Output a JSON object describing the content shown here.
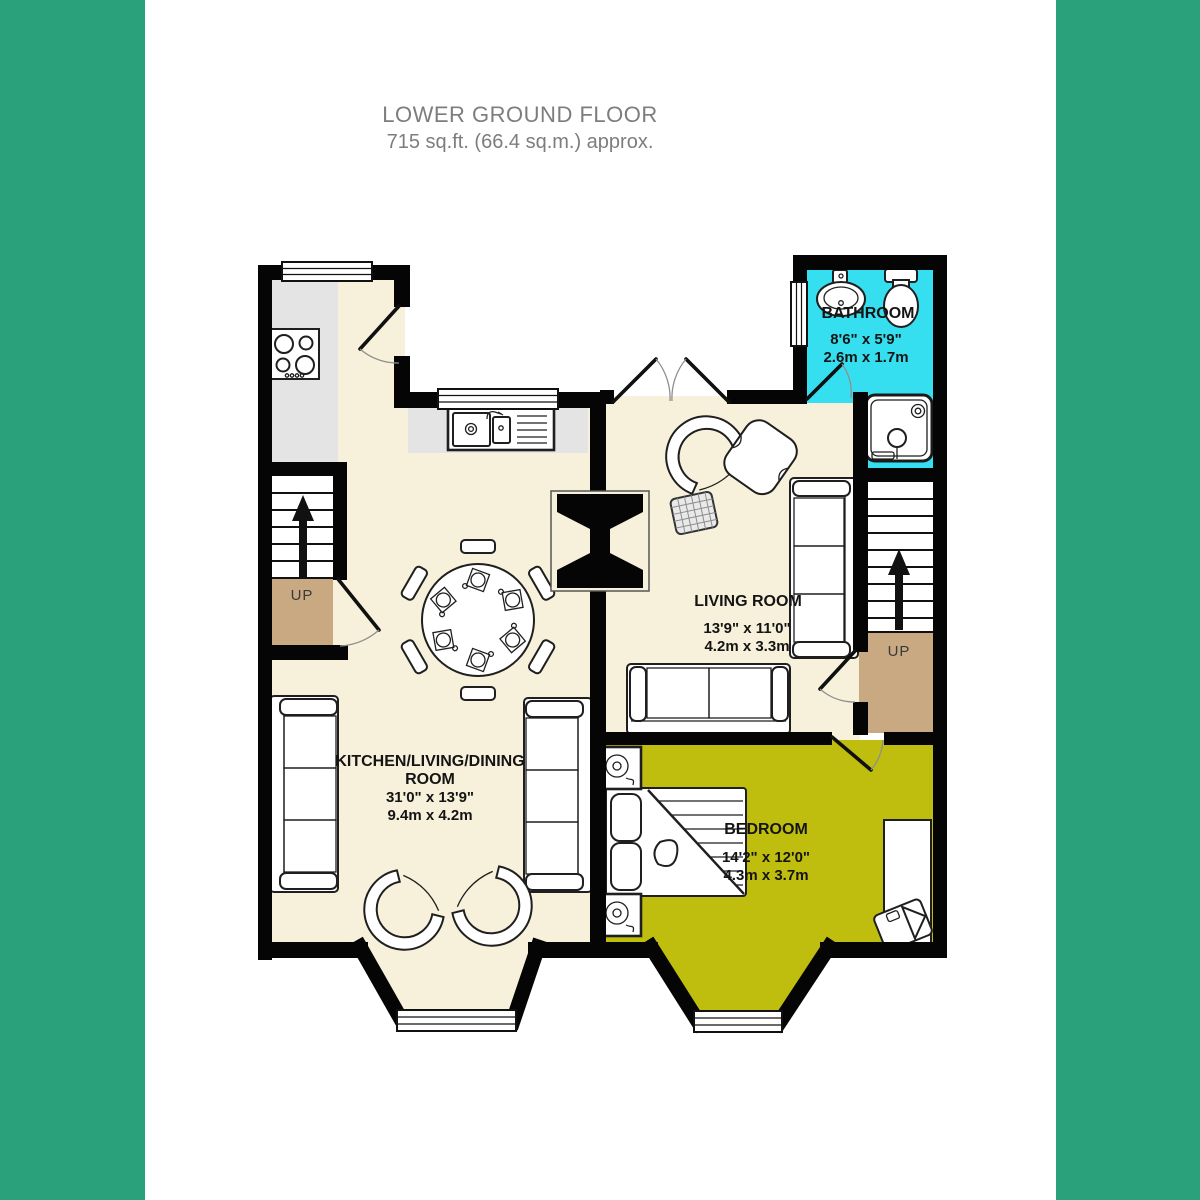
{
  "title": {
    "line1": "LOWER GROUND FLOOR",
    "line2": "715 sq.ft. (66.4 sq.m.) approx."
  },
  "colors": {
    "side_bars": "#2BA17B",
    "floor_cream": "#F7F1DB",
    "bedroom_olive": "#BFBE0E",
    "bathroom_cyan": "#36DFF0",
    "landing_tan": "#C9A982",
    "counter_gray": "#E4E4E4",
    "wall_black": "#050505",
    "title_gray": "#7D7D7D"
  },
  "rooms": {
    "bathroom": {
      "name": "BATHROOM",
      "dims_imperial": "8'6\" x 5'9\"",
      "dims_metric": "2.6m x 1.7m"
    },
    "living_room": {
      "name": "LIVING ROOM",
      "dims_imperial": "13'9\" x 11'0\"",
      "dims_metric": "4.2m x 3.3m"
    },
    "kitchen_living_dining": {
      "name_line1": "KITCHEN/LIVING/DINING",
      "name_line2": "ROOM",
      "dims_imperial": "31'0\" x 13'9\"",
      "dims_metric": "9.4m x 4.2m"
    },
    "bedroom": {
      "name": "BEDROOM",
      "dims_imperial": "14'2\" x 12'0\"",
      "dims_metric": "4.3m x 3.7m"
    }
  },
  "stairs": {
    "left_label": "UP",
    "right_label": "UP"
  }
}
